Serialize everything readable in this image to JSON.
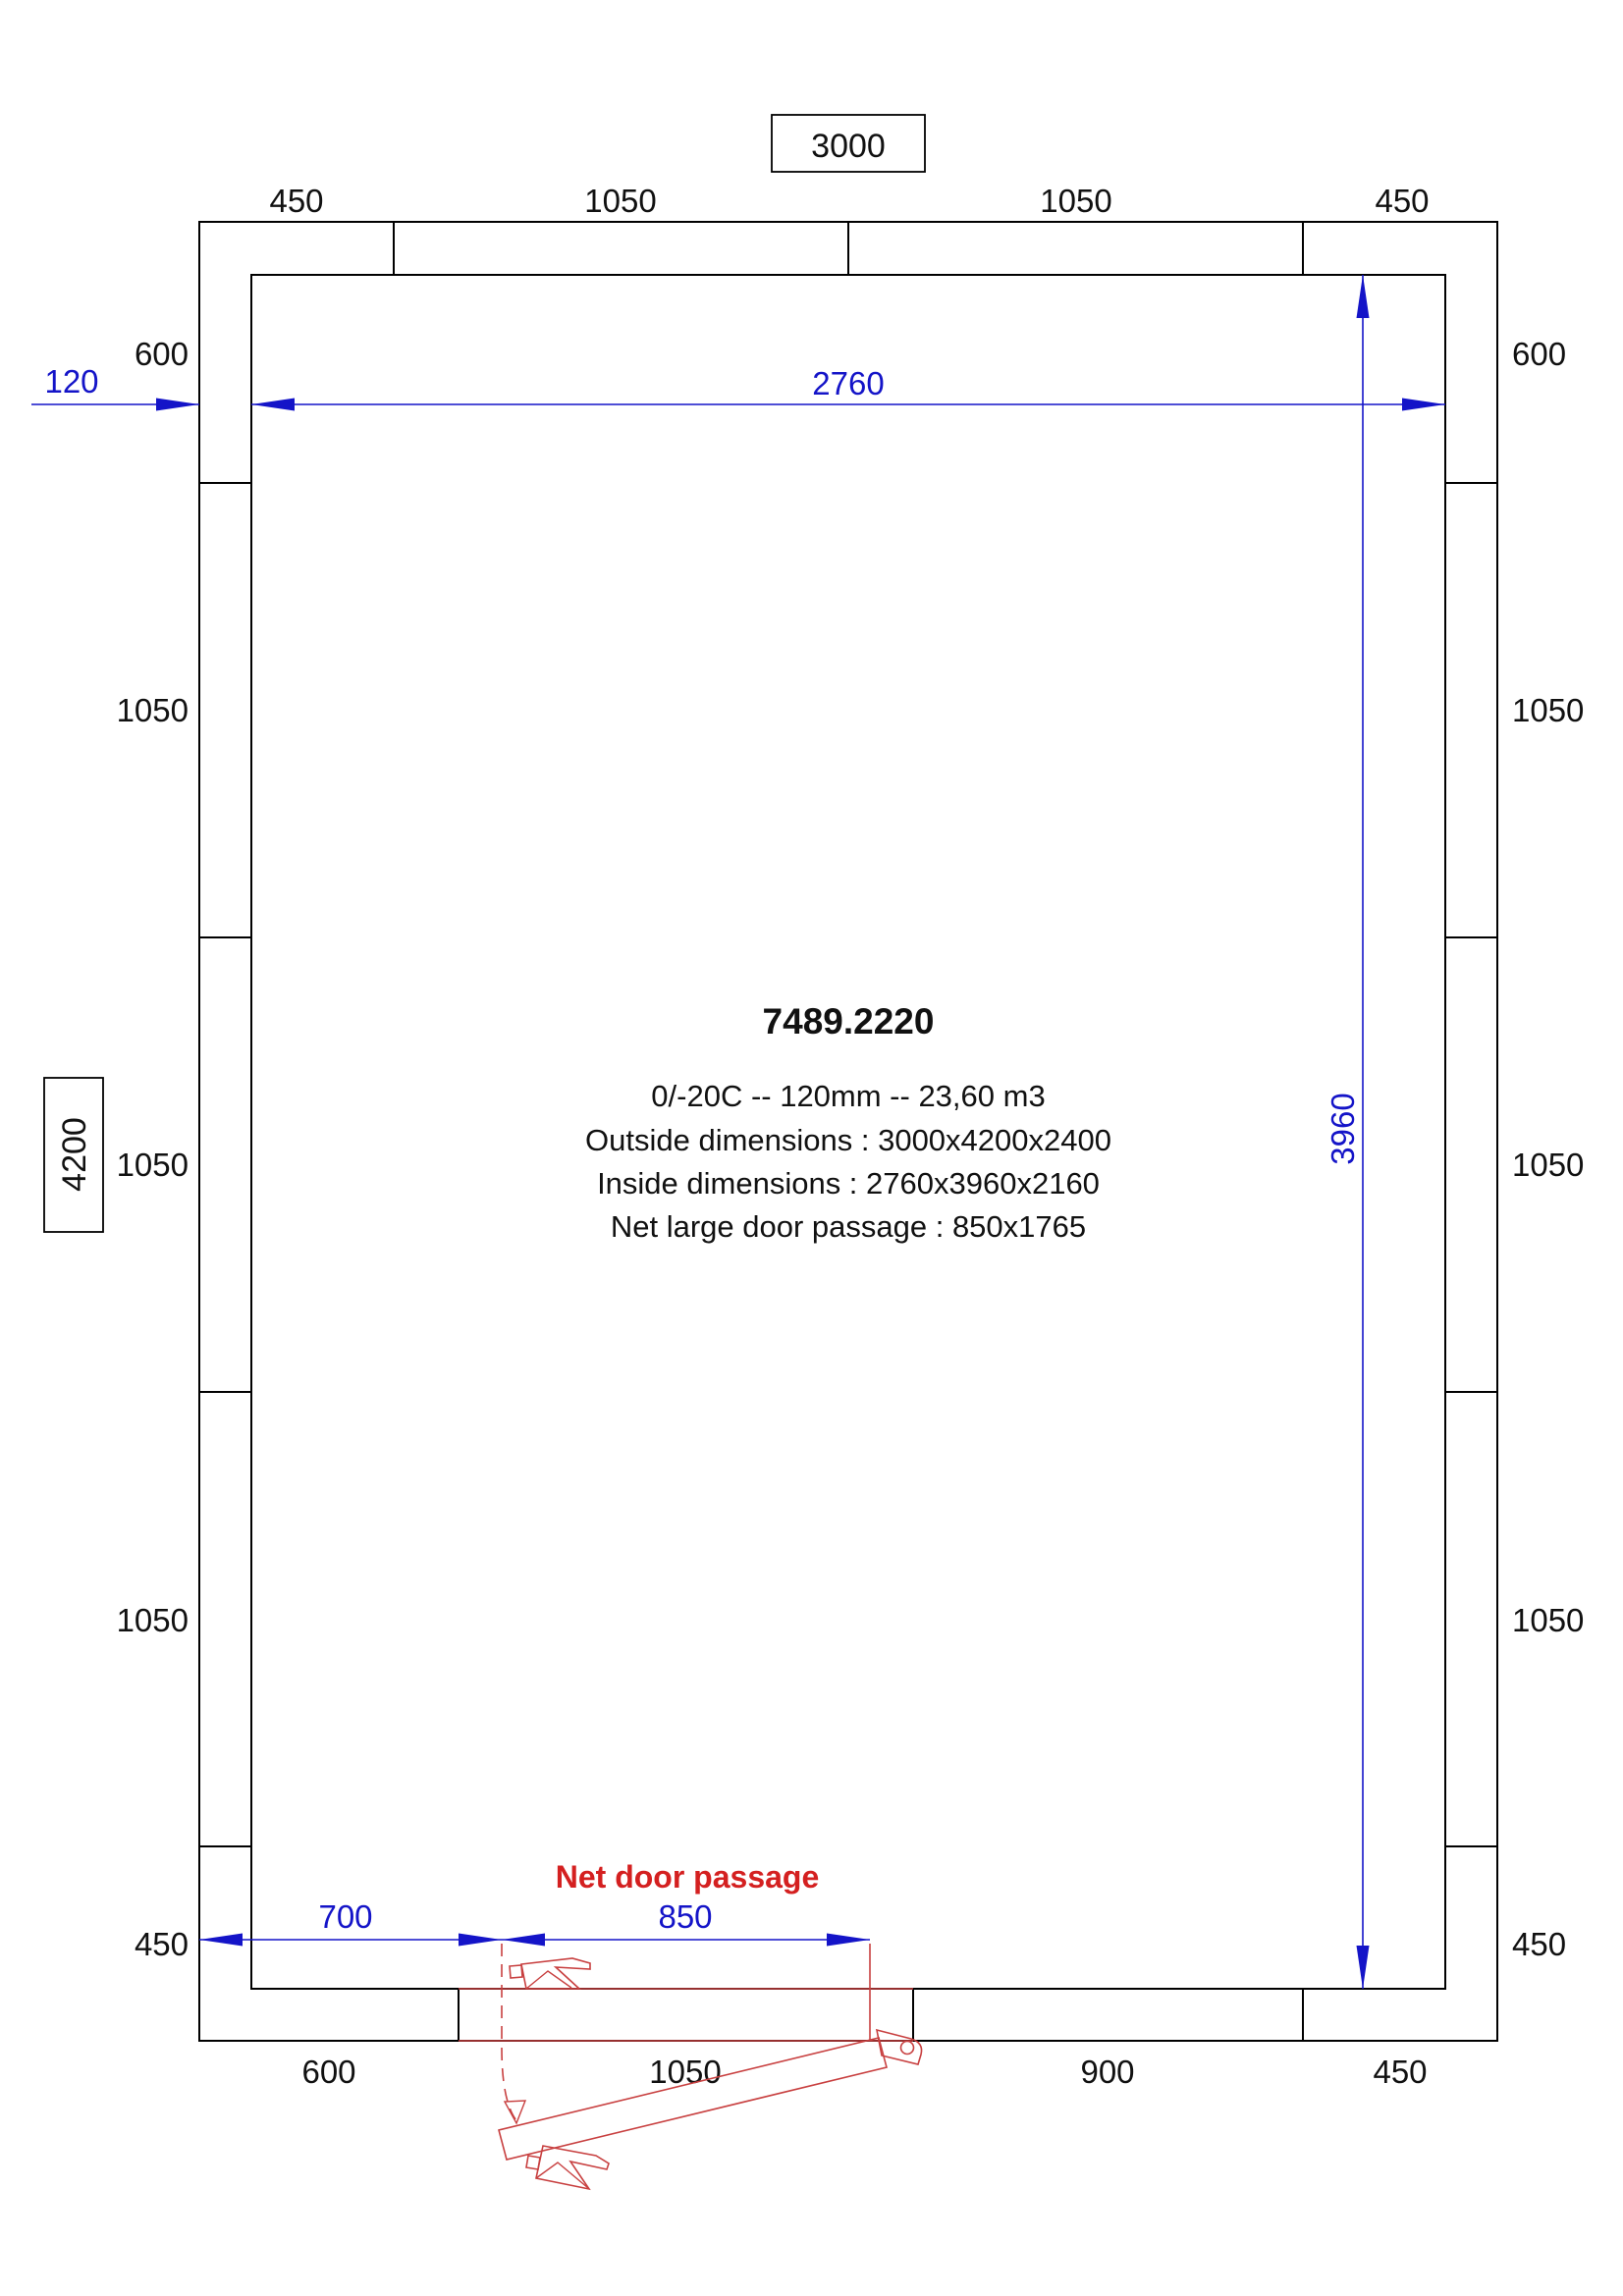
{
  "drawing": {
    "reference": "7489.2220",
    "spec_line": "0/-20C -- 120mm -- 23,60 m3",
    "outside_dimensions_line": "Outside dimensions : 3000x4200x2400",
    "inside_dimensions_line": "Inside dimensions : 2760x3960x2160",
    "net_large_door_passage_line": "Net large door passage : 850x1765"
  },
  "dimensions": {
    "overall_width": "3000",
    "overall_height": "4200",
    "inner_width": "2760",
    "inner_height": "3960",
    "wall_thickness": "120",
    "door_offset": "700",
    "door_passage": "850",
    "door_passage_caption": "Net door passage"
  },
  "panels": {
    "top": [
      "450",
      "1050",
      "1050",
      "450"
    ],
    "bottom": [
      "600",
      "1050",
      "900",
      "450"
    ],
    "left": [
      "600",
      "1050",
      "1050",
      "1050",
      "450"
    ],
    "right": [
      "600",
      "1050",
      "1050",
      "1050",
      "450"
    ]
  },
  "colors": {
    "dimension_blue": "#1414c8",
    "door_red": "#c84040",
    "text_red": "#d42020",
    "line_black": "#000000"
  }
}
